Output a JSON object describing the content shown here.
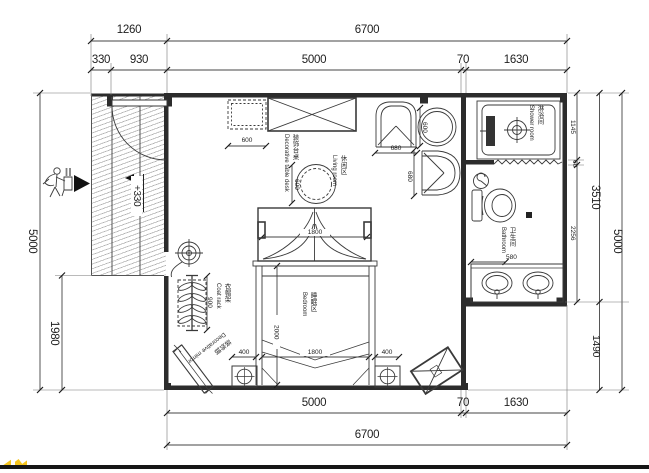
{
  "dims": {
    "t1260": "1260",
    "t6700": "6700",
    "t330": "330",
    "t930": "930",
    "t5000": "5000",
    "t70": "70",
    "t1630": "1630",
    "l5000": "5000",
    "l1980": "1980",
    "r1145": "1145",
    "r60": "60",
    "r2256": "2256",
    "r3510": "3510",
    "r1490": "1490",
    "r5000": "5000",
    "b5000": "5000",
    "b70": "70",
    "b1630": "1630",
    "b6700": "6700"
  },
  "fdims": {
    "cabinet600": "600",
    "decor600": "600",
    "chairA680": "680",
    "chairB680": "680",
    "table600": "600",
    "canopy1800": "1800",
    "bed2000": "2000",
    "bed1800": "1800",
    "ns400l": "400",
    "ns400r": "400",
    "bath580": "580",
    "rack900": "900"
  },
  "levels": {
    "entry": "+330"
  },
  "rooms": {
    "shower": {
      "zh": "淋浴间",
      "en": "Shower room"
    },
    "bathroom": {
      "zh": "卫生间",
      "en": "Bathroom"
    },
    "living": {
      "zh": "休闲区",
      "en": "Living room"
    },
    "bedroom": {
      "zh": "睡眠区",
      "en": "Bedroom"
    }
  },
  "annotations": {
    "coat_rack": {
      "zh": "衣帽架",
      "en": "Coat rack"
    },
    "mirror": {
      "zh": "装饰镜",
      "en": "Decorative mirror"
    },
    "decor_table": {
      "zh": "装饰台桌",
      "en": "Decorative table desk"
    }
  },
  "colors": {
    "line": "#3a3a3a",
    "wall": "#2c2c2c",
    "watermark_yellow": "#f6c51d"
  }
}
